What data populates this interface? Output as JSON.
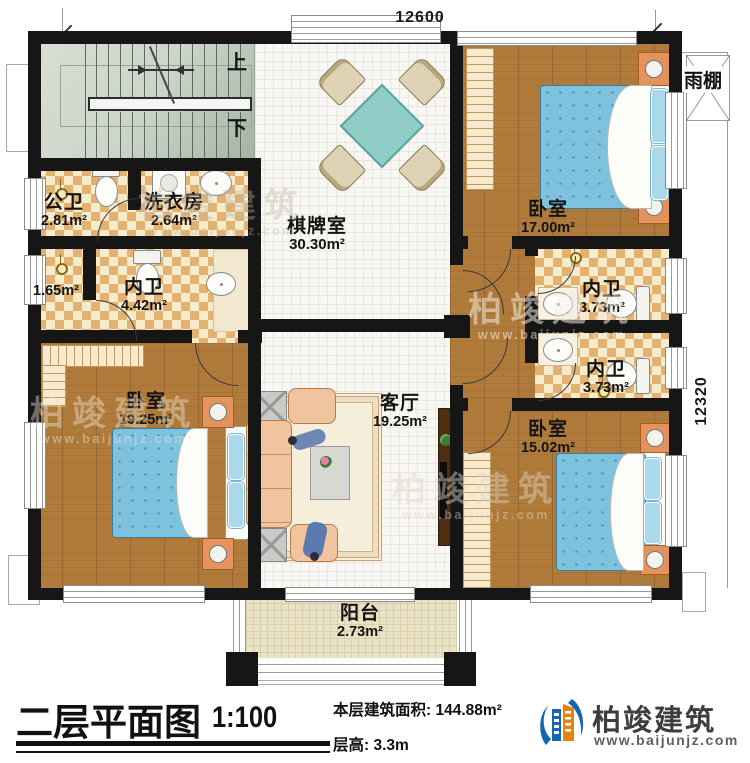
{
  "plan": {
    "dimensions": {
      "top": "12600",
      "right": "12320"
    },
    "stairs": {
      "up": "上",
      "down": "下"
    },
    "canopy": "雨棚",
    "rooms": [
      {
        "id": "public-bath",
        "name": "公卫",
        "area": "2.81m²"
      },
      {
        "id": "laundry",
        "name": "洗衣房",
        "area": "2.64m²"
      },
      {
        "id": "game-room",
        "name": "棋牌室",
        "area": "30.30m²"
      },
      {
        "id": "bedroom-ne",
        "name": "卧室",
        "area": "17.00m²"
      },
      {
        "id": "closet",
        "name": "",
        "area": "1.65m²"
      },
      {
        "id": "ensuite-w",
        "name": "内卫",
        "area": "4.42m²"
      },
      {
        "id": "ensuite-e1",
        "name": "内卫",
        "area": "3.73m²"
      },
      {
        "id": "ensuite-e2",
        "name": "内卫",
        "area": "3.73m²"
      },
      {
        "id": "bedroom-sw",
        "name": "卧室",
        "area": "19.25m²"
      },
      {
        "id": "living-room",
        "name": "客厅",
        "area": "19.25m²"
      },
      {
        "id": "bedroom-se",
        "name": "卧室",
        "area": "15.02m²"
      },
      {
        "id": "balcony",
        "name": "阳台",
        "area": "2.73m²"
      }
    ]
  },
  "titleblock": {
    "title": "二层平面图",
    "scale": "1:100",
    "area_label": "本层建筑面积: 144.88m²",
    "height_label": "层高: 3.3m"
  },
  "brand": {
    "name": "柏竣建筑",
    "url": "www.baijunjz.com",
    "blue": "#1565b0",
    "orange": "#e8820c"
  },
  "watermark": {
    "name": "柏竣建筑",
    "url": "www.baijunjz.com"
  }
}
